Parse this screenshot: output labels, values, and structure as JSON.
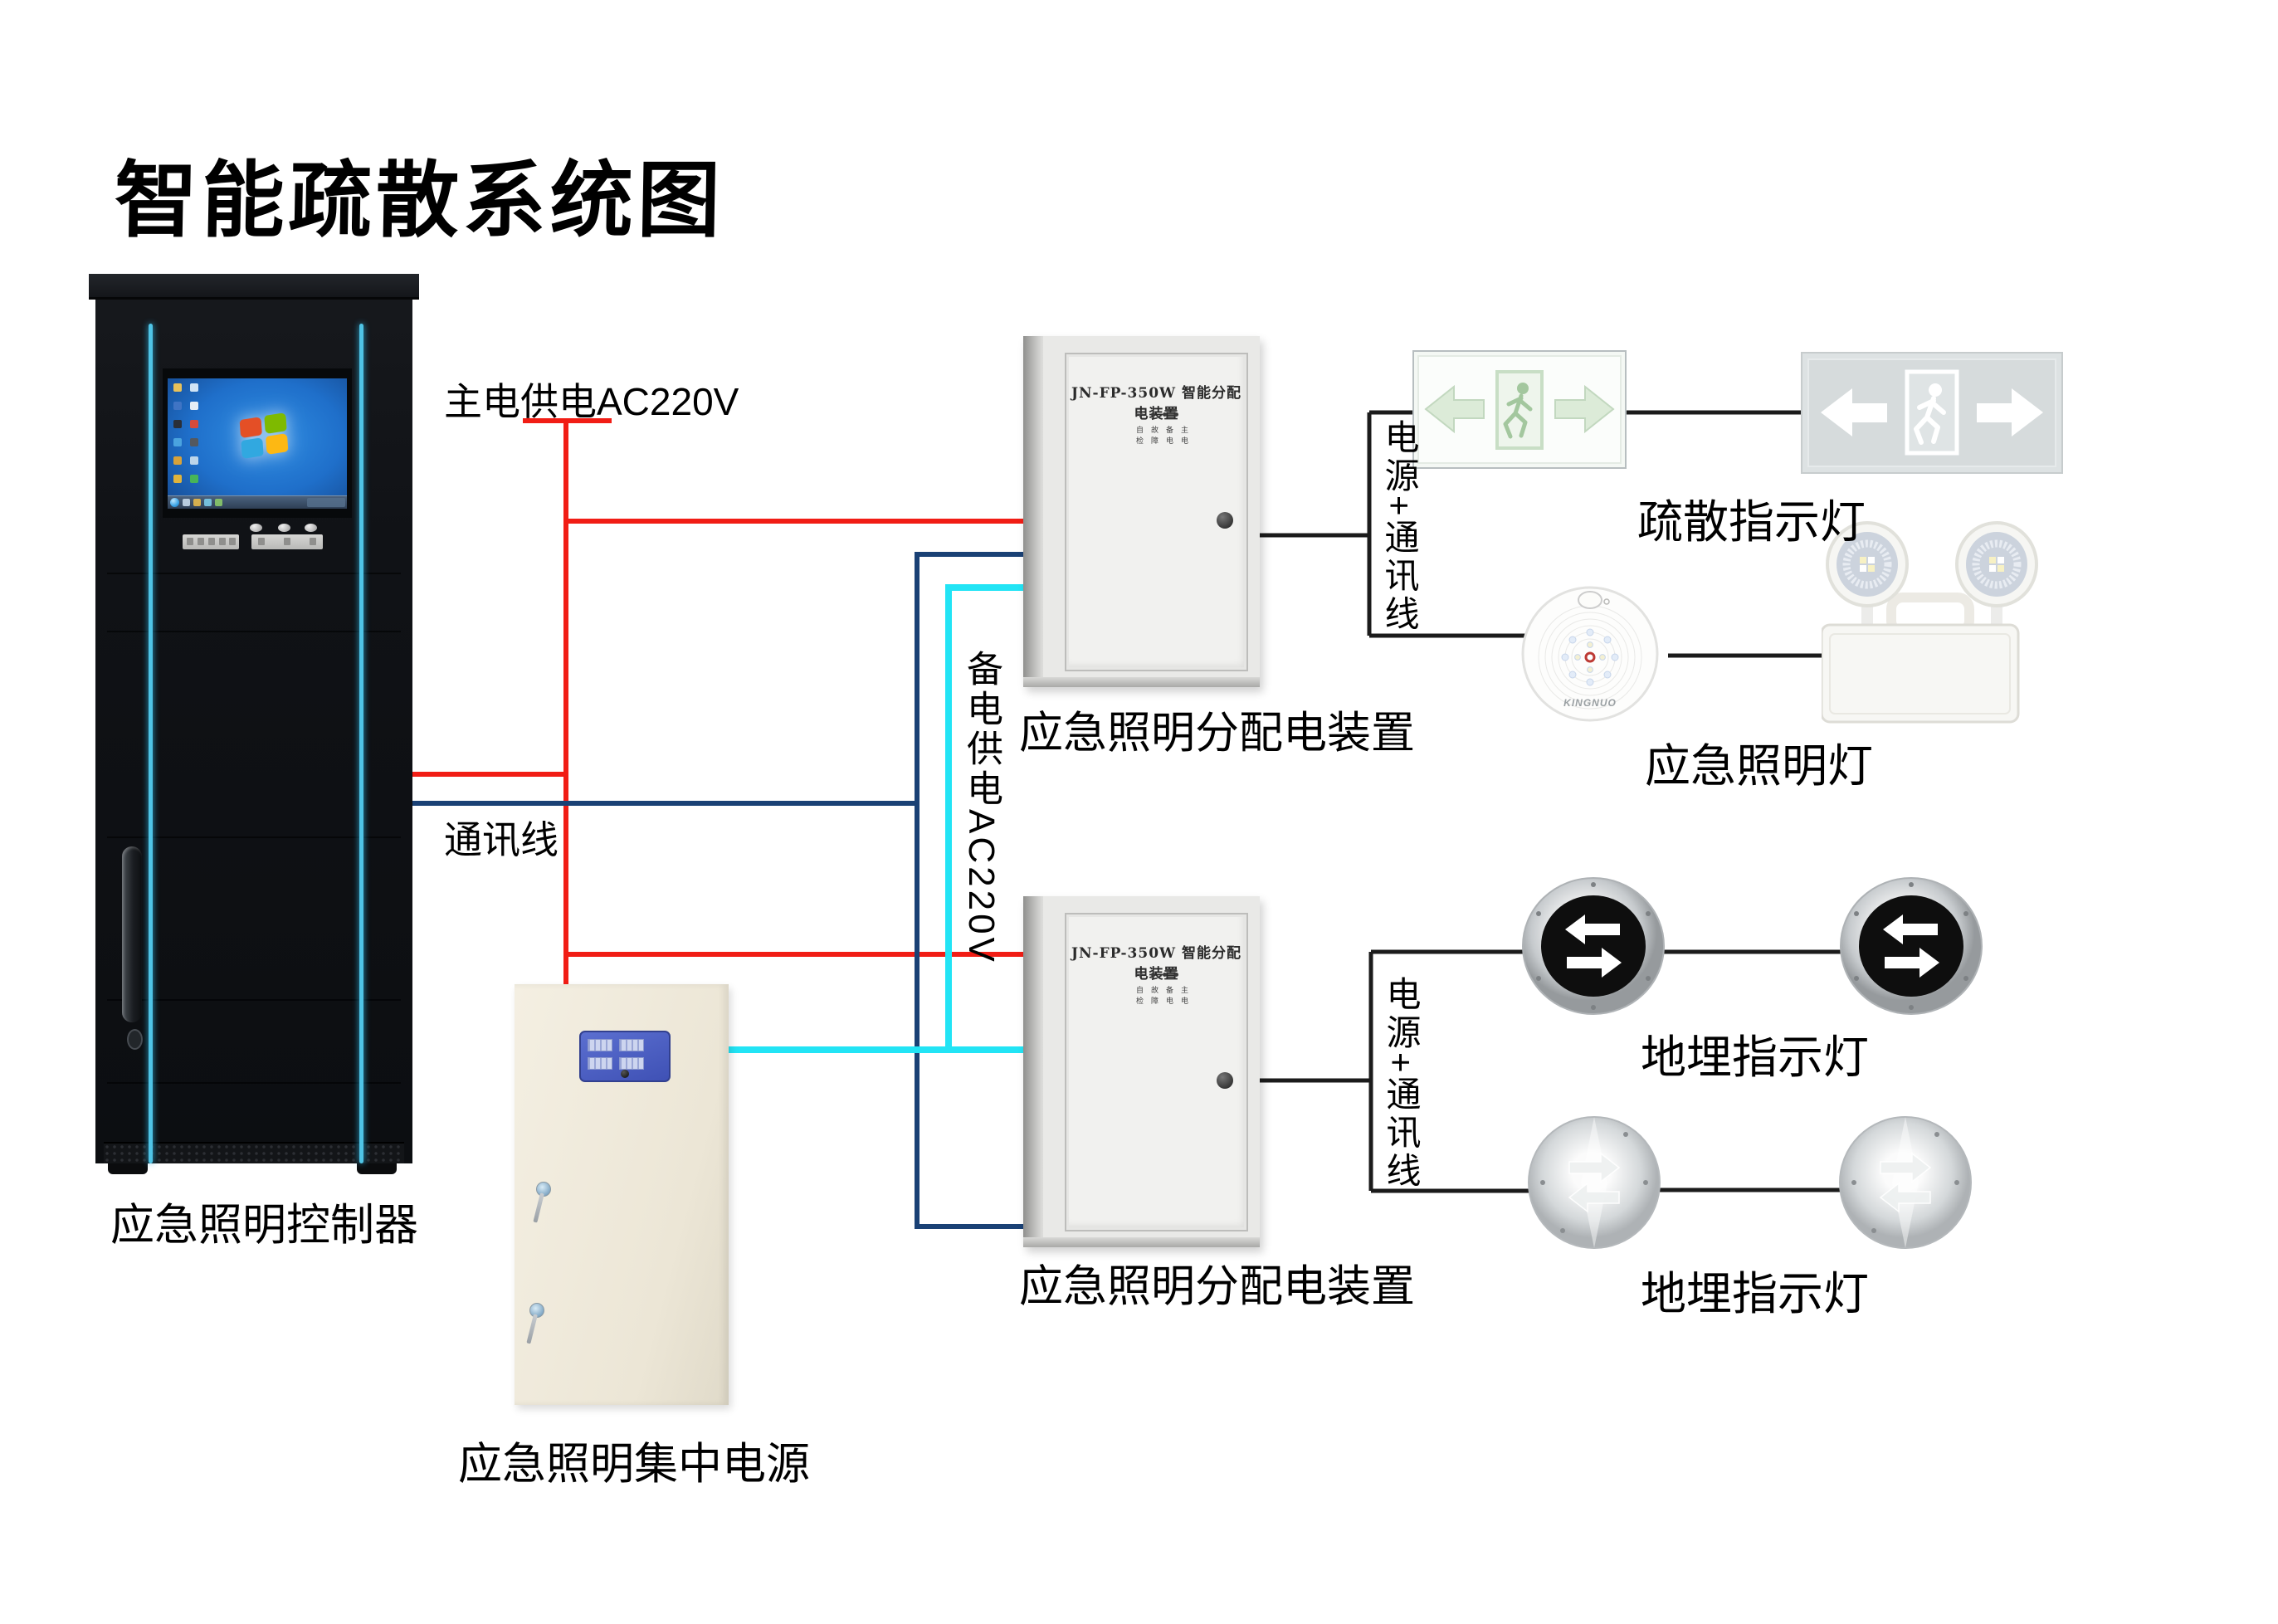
{
  "title": "智能疏散系统图",
  "colors": {
    "main_power_line": "#f11d15",
    "comm_line": "#1a4175",
    "backup_power_line": "#22e4f5",
    "device_line": "#1b1b1b",
    "cabinet_accent": "#4fc4e6"
  },
  "wire_labels": {
    "main_power": "主电供电AC220V",
    "comm": "通讯线",
    "backup_power": "备电供电AC220V",
    "power_comm": "电源+通讯线"
  },
  "cabinet": {
    "label": "应急照明控制器"
  },
  "distribution_box": {
    "model": "JN-FP-350W 智能分配电装置",
    "label": "应急照明分配电装置",
    "indicator_rows": [
      "自故备主",
      "检障电电"
    ]
  },
  "central_power": {
    "label": "应急照明集中电源"
  },
  "devices": {
    "exit_sign": {
      "label": "疏散指示灯"
    },
    "emergency_light": {
      "label": "应急照明灯",
      "brand": "KINGNUO"
    },
    "ground_light_arrow": {
      "label": "地埋指示灯"
    },
    "ground_light_steel": {
      "label": "地埋指示灯"
    }
  }
}
